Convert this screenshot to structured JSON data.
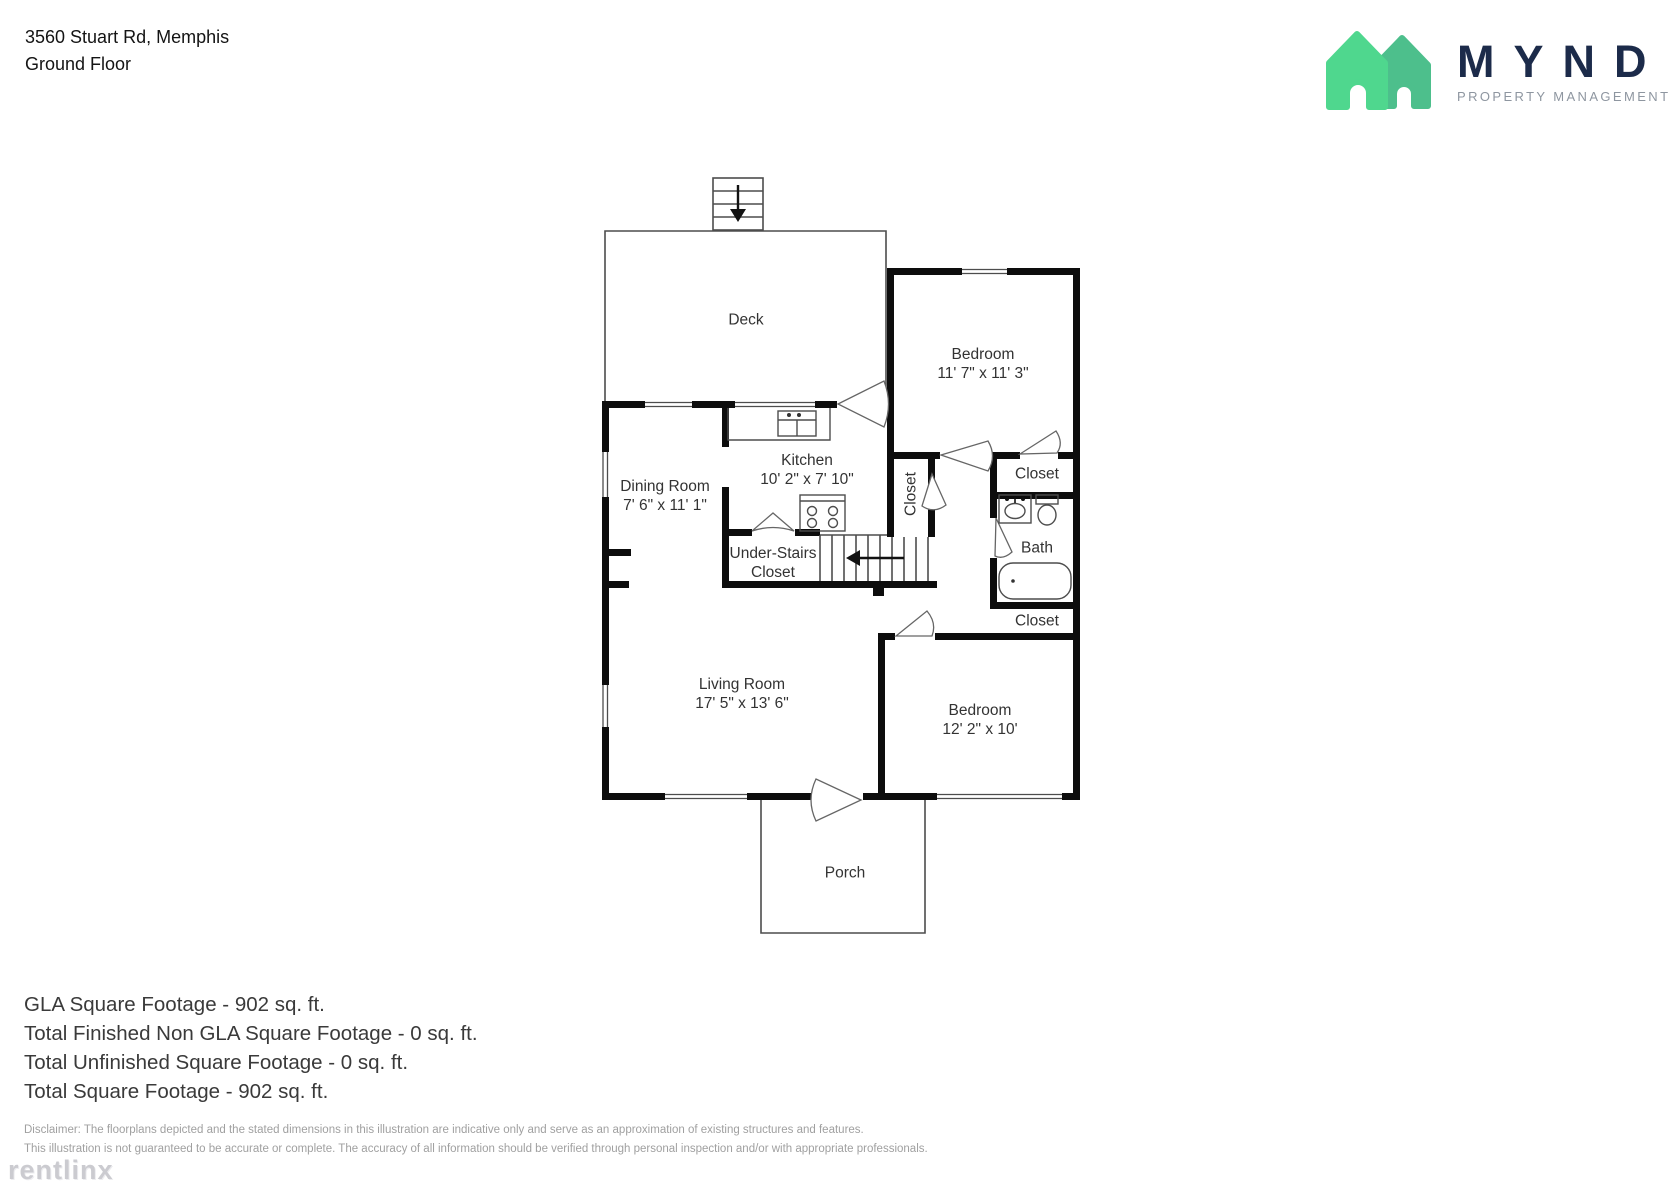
{
  "header": {
    "address": "3560 Stuart Rd, Memphis",
    "floor": "Ground Floor"
  },
  "logo": {
    "name": "MYND",
    "tagline": "PROPERTY MANAGEMENT",
    "colors": {
      "house_front": "#4fd78e",
      "house_back": "#4dbf8c",
      "wordmark": "#1c2b4a",
      "tagline": "#8e96a0"
    }
  },
  "floorplan": {
    "rooms": [
      {
        "id": "deck",
        "lines": [
          "Deck"
        ]
      },
      {
        "id": "bedroom-top",
        "lines": [
          "Bedroom",
          "11' 7\" x 11' 3\""
        ]
      },
      {
        "id": "dining-room",
        "lines": [
          "Dining Room",
          "7' 6\" x 11' 1\""
        ]
      },
      {
        "id": "kitchen",
        "lines": [
          "Kitchen",
          "10' 2\" x 7' 10\""
        ]
      },
      {
        "id": "closet-hall",
        "lines": [
          "Closet"
        ]
      },
      {
        "id": "under-stairs-closet",
        "lines": [
          "Under-Stairs",
          "Closet"
        ]
      },
      {
        "id": "closet-bedroom-top",
        "lines": [
          "Closet"
        ]
      },
      {
        "id": "bath",
        "lines": [
          "Bath"
        ]
      },
      {
        "id": "closet-bedroom-bottom",
        "lines": [
          "Closet"
        ]
      },
      {
        "id": "living-room",
        "lines": [
          "Living Room",
          "17' 5\" x 13' 6\""
        ]
      },
      {
        "id": "bedroom-bottom",
        "lines": [
          "Bedroom",
          "12' 2\" x 10'"
        ]
      },
      {
        "id": "porch",
        "lines": [
          "Porch"
        ]
      }
    ]
  },
  "summary": {
    "lines": [
      "GLA Square Footage - 902 sq. ft.",
      "Total Finished Non GLA Square Footage - 0 sq. ft.",
      "Total Unfinished Square Footage - 0 sq. ft.",
      "Total Square Footage - 902 sq. ft."
    ]
  },
  "disclaimer": {
    "line1": "Disclaimer: The floorplans depicted and the stated dimensions in this illustration are indicative only and serve as an approximation of existing structures and features.",
    "line2": "This illustration is not guaranteed to be accurate or complete. The accuracy of all information should be verified through personal inspection and/or with appropriate professionals."
  },
  "watermark": "rentlinx"
}
